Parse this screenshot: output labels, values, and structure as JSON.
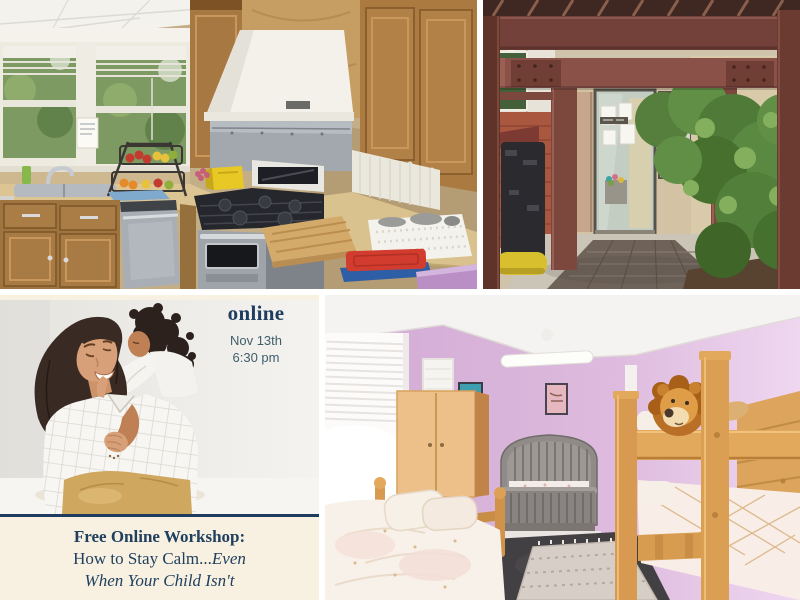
{
  "collage": {
    "background_color": "#ffffff"
  },
  "workshop_card": {
    "mode_label": "online",
    "date": "Nov 13th",
    "time": "6:30 pm",
    "title": "Free Online Workshop:",
    "subtitle_part1": "How to Stay Calm...",
    "subtitle_emphasis": "Even",
    "subtitle_line2": "When Your Child Isn't",
    "colors": {
      "accent_navy": "#1d3c5e",
      "card_cream": "#f8f1e2",
      "date_text": "#3f5d6b"
    }
  },
  "photos": {
    "kitchen": {
      "description": "Kitchen with wooden cabinets, stainless steel stove, sink, white range hood and tiered fruit baskets"
    },
    "entrance": {
      "description": "Wooden pergola walkway leading to a glass nursery entrance door beside a green shrub"
    },
    "mother_child": {
      "description": "Smiling mother with a child hugging her from behind"
    },
    "bedroom": {
      "description": "Children's bedroom with pink walls, twin bed, grey crib and wooden bunk bed with plush lion"
    }
  }
}
